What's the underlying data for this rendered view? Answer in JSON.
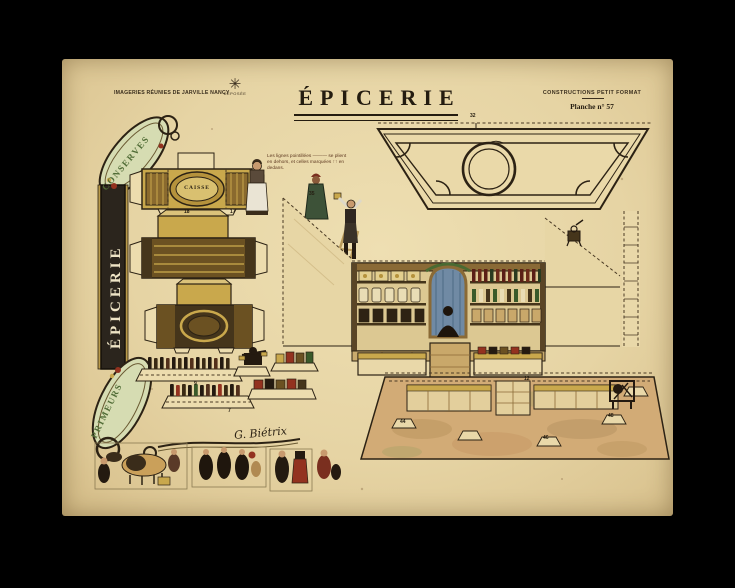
{
  "window": {
    "background": "#000000"
  },
  "sheet": {
    "paper_color": "#e6d4a4"
  },
  "header": {
    "imprint": "IMAGERIES RÉUNIES DE JARVILLE NANCY",
    "trademark_label": "DÉPOSÉE",
    "title": "ÉPICERIE",
    "series": "CONSTRUCTIONS PETIT FORMAT",
    "plate": "Planche n° 57"
  },
  "frame": {
    "top_word": "CONSERVES",
    "vertical_word": "ÉPICERIE",
    "bottom_word": "PRIMEURS"
  },
  "instructions": {
    "line1": "Les lignes pointillées ——— se plient",
    "line2": "en dehors, et celles marquées ↑↑ en",
    "line3": "dedans."
  },
  "pieces": {
    "cash_desk_label": "CAISSE"
  },
  "signature": "G. Biétrix",
  "tabs": [
    "32",
    "35",
    "17",
    "18",
    "9",
    "7",
    "44",
    "46",
    "48",
    "12"
  ],
  "palette": {
    "paper": "#e6d4a4",
    "ink": "#2c2214",
    "gold": "#c9a84c",
    "dark_wood": "#45351b",
    "green": "#4f6b35",
    "red": "#93321f",
    "curtain_blue": "#708aa4",
    "floor_tan": "#d2ab76"
  }
}
